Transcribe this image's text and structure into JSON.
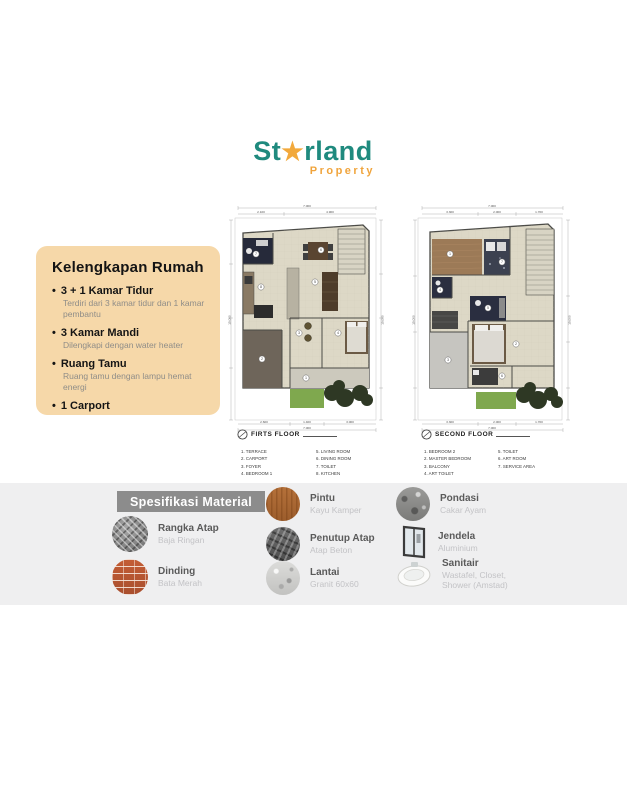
{
  "logo": {
    "part1": "St",
    "star": "★",
    "part2": "rland",
    "subtitle": "Property",
    "teal": "#1f8a7e",
    "orange": "#f0a43c"
  },
  "features_card": {
    "title": "Kelengkapan Rumah",
    "items": [
      {
        "heading": "3 + 1 Kamar Tidur",
        "detail": "Terdiri dari 3 kamar tidur dan 1 kamar pembantu"
      },
      {
        "heading": "3 Kamar Mandi",
        "detail": "Dilengkapi dengan water heater"
      },
      {
        "heading": "Ruang Tamu",
        "detail": "Ruang tamu dengan lampu hemat energi"
      },
      {
        "heading": "1 Carport",
        "detail": ""
      }
    ]
  },
  "plans": [
    {
      "title": "FIRTS FLOOR",
      "legend_col1": [
        "1. TERRACE",
        "2. CARPORT",
        "3. FOYER",
        "4. BEDROOM 1"
      ],
      "legend_col2": [
        "5. LIVING ROOM",
        "6. DINING ROOM",
        "7. TOILET",
        "8. KITCHEN"
      ],
      "rooms": [
        "1",
        "2",
        "3",
        "4",
        "5",
        "6",
        "7",
        "8"
      ],
      "dims": {
        "w": "7.000",
        "wa": "2.100",
        "wb": "4.900",
        "hl": "15.000",
        "hr": "15.000",
        "ba": "2.600",
        "bb": "1.400",
        "bc": "3.000",
        "b": "7.000"
      }
    },
    {
      "title": "SECOND FLOOR",
      "legend_col1": [
        "1. BEDROOM 2",
        "2. MASTER BEDROOM",
        "3. BALCONY",
        "4. ART TOILET"
      ],
      "legend_col2": [
        "5. TOILET",
        "6. ART ROOM",
        "7. SERVICE AREA"
      ],
      "rooms": [
        "1",
        "7",
        "4",
        "5",
        "2",
        "3",
        "6"
      ],
      "dims": {
        "w": "7.000",
        "wa": "3.300",
        "wb": "2.000",
        "wc": "1.700",
        "hl": "15.000",
        "hr": "15.000",
        "ba": "3.300",
        "bb": "2.000",
        "bc": "1.700",
        "b": "7.000"
      }
    }
  ],
  "materials": {
    "title": "Spesifikasi Material",
    "items": [
      {
        "icon": "steel-frame-icon",
        "title": "Rangka Atap",
        "subtitle": "Baja Ringan"
      },
      {
        "icon": "red-brick-icon",
        "title": "Dinding",
        "subtitle": "Bata Merah"
      },
      {
        "icon": "wood-icon",
        "title": "Pintu",
        "subtitle": "Kayu Kamper"
      },
      {
        "icon": "roof-tile-icon",
        "title": "Penutup Atap",
        "subtitle": "Atap Beton"
      },
      {
        "icon": "granite-icon",
        "title": "Lantai",
        "subtitle": "Granit 60x60"
      },
      {
        "icon": "foundation-icon",
        "title": "Pondasi",
        "subtitle": "Cakar Ayam"
      },
      {
        "icon": "window-icon",
        "title": "Jendela",
        "subtitle": "Aluminium"
      },
      {
        "icon": "sink-icon",
        "title": "Sanitair",
        "subtitle": "Wastafel, Closet, Shower (Amstad)"
      }
    ]
  },
  "colors": {
    "card_bg": "#f6d8a9",
    "band_bg": "#efeff0",
    "spec_box": "#8c8c8c",
    "floor_beige": "#ddd8c6",
    "carport": "#6e655a",
    "garden_green": "#7fa84e"
  }
}
